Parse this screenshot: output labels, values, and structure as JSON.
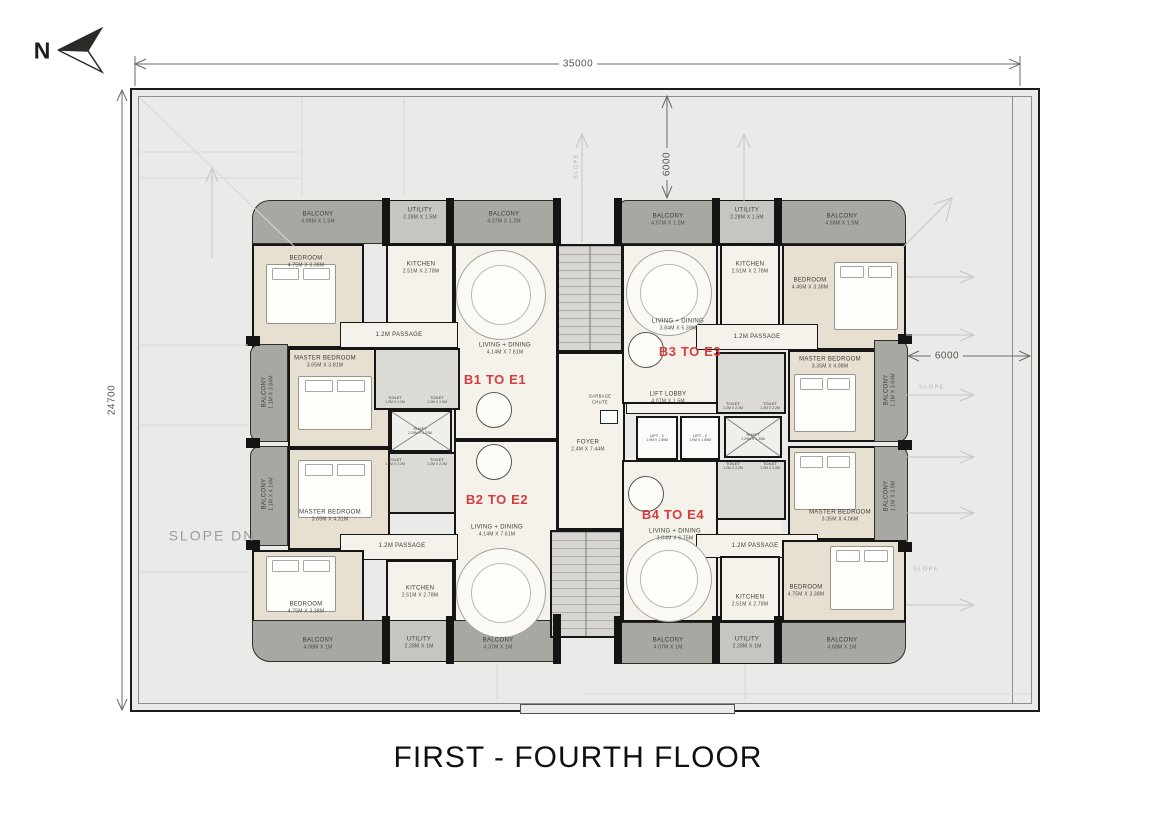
{
  "title": "FIRST - FOURTH FLOOR",
  "north_label": "N",
  "colors": {
    "unit_label": "#d63c3c",
    "wall": "#161616",
    "balcony": "#a8a8a2",
    "terrace": "#eaeae8"
  },
  "dimensions": {
    "overall_width": "35000",
    "overall_height": "24700",
    "terrace_top": "6000",
    "terrace_right": "6000"
  },
  "annotations": {
    "slope": "SLOPE",
    "slope_dn": "SLOPE DN"
  },
  "units": {
    "b1": "B1 TO E1",
    "b2": "B2 TO E2",
    "b3": "B3 TO E3",
    "b4": "B4 TO E4"
  },
  "core": {
    "foyer": {
      "name": "FOYER",
      "size": "2.4M X 7.44M"
    },
    "garbage_chute": {
      "name": "GARBAGE CHUTE"
    },
    "lift_lobby": {
      "name": "LIFT LOBBY",
      "size": "4.07M X 1.5M"
    },
    "lift1": {
      "name": "LIFT - 1",
      "size": "1.9M X 1.55M"
    },
    "lift2": {
      "name": "LIFT - 2",
      "size": "1.9M X 1.55M"
    },
    "shaft": {
      "name": "SHAFT",
      "size": "2.29M X 1.33M"
    },
    "toilet": {
      "name": "TOILET",
      "size": "1.2M X 2.2M"
    }
  },
  "b1": {
    "balcony_top": {
      "name": "BALCONY",
      "size": "4.98M X 1.5M"
    },
    "utility": {
      "name": "UTILITY",
      "size": "2.28M X 1.5M"
    },
    "balcony_top2": {
      "name": "BALCONY",
      "size": "4.37M X 1.2M"
    },
    "bedroom": {
      "name": "BEDROOM",
      "size": "4.75M X 3.38M"
    },
    "kitchen": {
      "name": "KITCHEN",
      "size": "2.51M X 2.78M"
    },
    "passage": "1.2M PASSAGE",
    "living": {
      "name": "LIVING + DINING",
      "size": "4.14M X 7.61M"
    },
    "master": {
      "name": "MASTER BEDROOM",
      "size": "3.65M X 3.81M"
    },
    "balcony_side": {
      "name": "BALCONY",
      "size": "1.1M X 3.84M"
    },
    "shaft": {
      "name": "SHAFT",
      "size": "2.29M X 1.33M"
    }
  },
  "b2": {
    "master": {
      "name": "MASTER BEDROOM",
      "size": "3.65M X 4.31M"
    },
    "balcony_side": {
      "name": "BALCONY",
      "size": "1.1M X 4.14M"
    },
    "living": {
      "name": "LIVING + DINING",
      "size": "4.14M X 7.61M"
    },
    "passage": "1.2M PASSAGE",
    "kitchen": {
      "name": "KITCHEN",
      "size": "2.51M X 2.78M"
    },
    "bedroom": {
      "name": "BEDROOM",
      "size": "4.75M X 3.38M"
    },
    "balcony_bottom": {
      "name": "BALCONY",
      "size": "4.98M X 1M"
    },
    "utility": {
      "name": "UTILITY",
      "size": "2.28M X 1M"
    },
    "balcony_bottom2": {
      "name": "BALCONY",
      "size": "4.37M X 1M"
    }
  },
  "b3": {
    "balcony_top": {
      "name": "BALCONY",
      "size": "4.07M X 1.2M"
    },
    "utility": {
      "name": "UTILITY",
      "size": "2.28M X 1.5M"
    },
    "balcony_top2": {
      "name": "BALCONY",
      "size": "4.58M X 1.5M"
    },
    "living": {
      "name": "LIVING + DINING",
      "size": "3.84M X 5.39M"
    },
    "kitchen": {
      "name": "KITCHEN",
      "size": "2.51M X 2.78M"
    },
    "bedroom": {
      "name": "BEDROOM",
      "size": "4.45M X 3.38M"
    },
    "passage": "1.2M PASSAGE",
    "master": {
      "name": "MASTER BEDROOM",
      "size": "3.35M X 4.98M"
    },
    "balcony_side": {
      "name": "BALCONY",
      "size": "1.1M X 3.84M"
    }
  },
  "b4": {
    "master": {
      "name": "MASTER BEDROOM",
      "size": "3.35M X 4.06M"
    },
    "balcony_side": {
      "name": "BALCONY",
      "size": "1.1M X 3.9M"
    },
    "living": {
      "name": "LIVING + DINING",
      "size": "3.84M X 6.75M"
    },
    "passage": "1.2M PASSAGE",
    "kitchen": {
      "name": "KITCHEN",
      "size": "2.51M X 2.78M"
    },
    "bedroom": {
      "name": "BEDROOM",
      "size": "4.75M X 3.38M"
    },
    "balcony_bottom": {
      "name": "BALCONY",
      "size": "4.07M X 1M"
    },
    "utility": {
      "name": "UTILITY",
      "size": "2.28M X 1M"
    },
    "balcony_bottom2": {
      "name": "BALCONY",
      "size": "4.68M X 1M"
    }
  }
}
